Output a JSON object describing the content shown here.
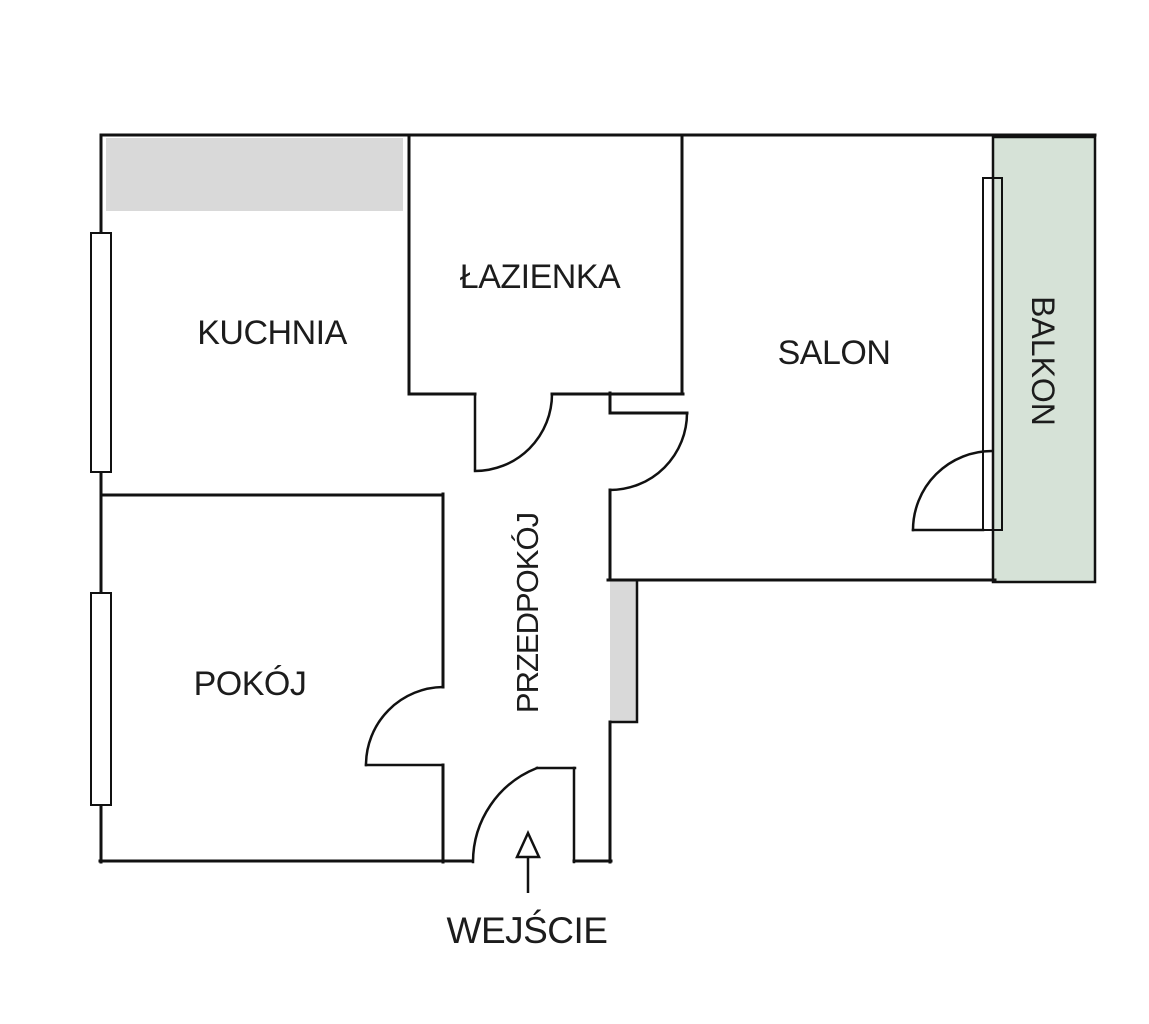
{
  "diagram_type": "apartment-floor-plan",
  "rooms": {
    "kuchnia": {
      "label": "KUCHNIA"
    },
    "lazienka": {
      "label": "ŁAZIENKA"
    },
    "salon": {
      "label": "SALON"
    },
    "pokoj": {
      "label": "POKÓJ"
    },
    "przedpokoj": {
      "label": "PRZEDPOKÓJ"
    },
    "balkon": {
      "label": "BALKON"
    }
  },
  "entrance": {
    "label": "WEJŚCIE",
    "marker": "up-arrow"
  },
  "colors": {
    "background": "#ffffff",
    "wall": "#111111",
    "balcony_fill": "#d6e2d7",
    "fixture_fill": "#d9d9d9",
    "window_fill": "#ffffff"
  }
}
